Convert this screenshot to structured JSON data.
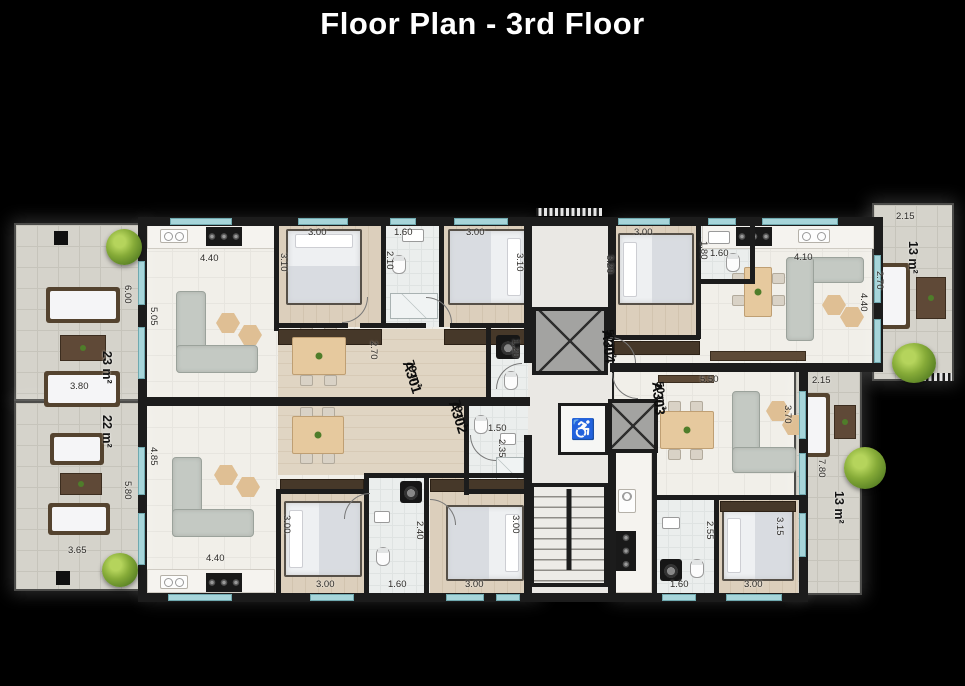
{
  "title": "Floor Plan - 3rd Floor",
  "apartments": {
    "a301": {
      "id": "A301",
      "area": "79 m²"
    },
    "a302": {
      "id": "A302",
      "area": "79 m²"
    },
    "a303": {
      "id": "A303",
      "area": "50 m²"
    },
    "a304": {
      "id": "A304",
      "area": "50 m²"
    }
  },
  "balconies": {
    "top_left": {
      "area": "23 m²",
      "width": "3.80",
      "depth": "6.00"
    },
    "bottom_left": {
      "area": "22 m²",
      "width": "3.65",
      "depth": "5.80"
    },
    "top_right": {
      "area": "13 m²",
      "width": "2.15",
      "depth": "2.70"
    },
    "bottom_right": {
      "area": "13 m²",
      "width": "2.15",
      "depth": "7.80"
    }
  },
  "dims": {
    "a301": {
      "living_w": "4.40",
      "living_h": "5.05",
      "bed1_w": "3.00",
      "bed1_h": "3.10",
      "bath_w": "1.60",
      "bath_h": "2.10",
      "bed2_w": "3.00",
      "bed2_h": "3.10",
      "hall_h": "2.70",
      "wc_h": "1.20"
    },
    "a302": {
      "living_w": "4.40",
      "living_h": "4.85",
      "bed1_w": "3.00",
      "bed1_h": "3.00",
      "bath_w": "1.60",
      "bath_h": "2.40",
      "bed2_w": "3.00",
      "bed2_h": "3.00",
      "wc_w": "1.50",
      "wc_h": "2.35"
    },
    "a303": {
      "living_w": "5.50",
      "living_h": "3.70",
      "bed_w": "3.00",
      "bed_h": "3.15",
      "bath_w": "1.60",
      "bath_h": "2.55"
    },
    "a304": {
      "bed_w": "3.00",
      "bed_h": "3.20",
      "bath_w": "1.60",
      "bath_h": "1.80",
      "living_w": "4.10",
      "living_h": "4.40"
    }
  },
  "icons": {
    "wheelchair": "♿"
  },
  "colors": {
    "background": "#000000",
    "wall": "#1c1c1c",
    "window": "#a7d5da"
  }
}
